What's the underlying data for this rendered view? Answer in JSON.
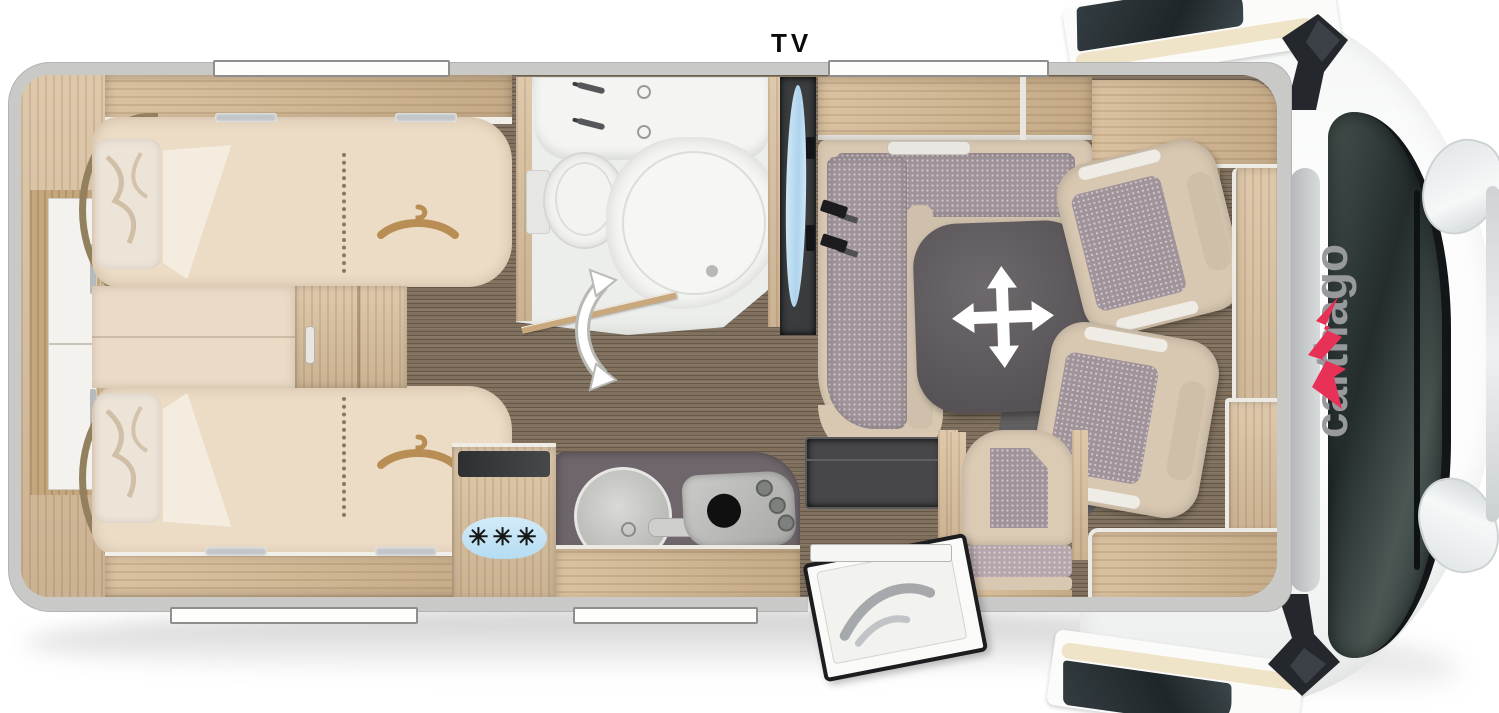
{
  "labels": {
    "tv": "TV",
    "brand": "carthago"
  },
  "icons": {
    "freezer_snowflakes": "✳✳✳",
    "hanger": "clothes-hanger",
    "table_move": "four-way-arrow",
    "door_swing": "curved-double-arrow"
  },
  "colors": {
    "wall": "#c9cac7",
    "wood": "#d9bf9d",
    "carpet": "#80705d",
    "mattress": "#ecdcc6",
    "upholstery_beige": "#d8c8b2",
    "fabric_gray": "#a0949a",
    "table": "#5b575a",
    "tv_screen": "#bfe0f4",
    "freezer_badge": "#bfe2f5",
    "brand_gray": "#97999c",
    "brand_red": "#e73156"
  }
}
